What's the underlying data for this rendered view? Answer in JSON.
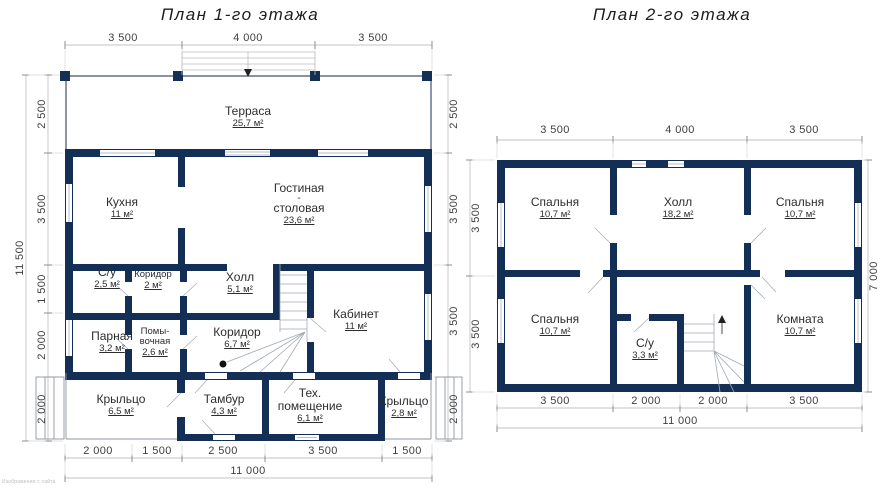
{
  "floor1": {
    "title": "План 1-го этажа",
    "rooms": [
      {
        "lines": [
          "Терраса"
        ],
        "area": "25,7 м²"
      },
      {
        "lines": [
          "Кухня"
        ],
        "area": "11 м²"
      },
      {
        "lines": [
          "Гостиная",
          "-",
          "столовая"
        ],
        "area": "23,6 м²"
      },
      {
        "lines": [
          "С/у"
        ],
        "area": "2,5 м²"
      },
      {
        "lines": [
          "Коридор"
        ],
        "area": "2 м²"
      },
      {
        "lines": [
          "Холл"
        ],
        "area": "5,1 м²"
      },
      {
        "lines": [
          "Парная"
        ],
        "area": "3,2 м²"
      },
      {
        "lines": [
          "Помы-",
          "вочная"
        ],
        "area": "2,6 м²"
      },
      {
        "lines": [
          "Коридор"
        ],
        "area": "6,7 м²"
      },
      {
        "lines": [
          "Кабинет"
        ],
        "area": "11 м²"
      },
      {
        "lines": [
          "Крыльцо"
        ],
        "area": "6,5 м²"
      },
      {
        "lines": [
          "Тамбур"
        ],
        "area": "4,3 м²"
      },
      {
        "lines": [
          "Тех.",
          "помещение"
        ],
        "area": "6,1 м²"
      },
      {
        "lines": [
          "Крыльцо"
        ],
        "area": "2,8 м²"
      }
    ],
    "dims": {
      "top": [
        "3 500",
        "4 000",
        "3 500"
      ],
      "left": [
        "2 500",
        "3 500",
        "1 500",
        "2 000",
        "2 000"
      ],
      "left_total": "11 500",
      "right": [
        "2 500",
        "3 500",
        "3 500",
        "2 000"
      ],
      "bottom": [
        "2 000",
        "1 500",
        "2 500",
        "3 500",
        "1 500"
      ],
      "bottom_total": "11 000"
    }
  },
  "floor2": {
    "title": "План 2-го этажа",
    "rooms": [
      {
        "lines": [
          "Спальня"
        ],
        "area": "10,7 м²"
      },
      {
        "lines": [
          "Холл"
        ],
        "area": "18,2 м²"
      },
      {
        "lines": [
          "Спальня"
        ],
        "area": "10,7 м²"
      },
      {
        "lines": [
          "Спальня"
        ],
        "area": "10,7 м²"
      },
      {
        "lines": [
          "С/у"
        ],
        "area": "3,3 м²"
      },
      {
        "lines": [
          "Комната"
        ],
        "area": "10,7 м²"
      }
    ],
    "dims": {
      "top": [
        "3 500",
        "4 000",
        "3 500"
      ],
      "left": [
        "3 500",
        "3 500"
      ],
      "right_total": "7 000",
      "bottom": [
        "3 500",
        "2 000",
        "2 000",
        "3 500"
      ],
      "bottom_total": "11 000"
    }
  },
  "watermark": "Изображение с сайта",
  "colors": {
    "wall": "#132f56",
    "dim_line": "#c3c3c3",
    "text": "#2d2d2d"
  }
}
